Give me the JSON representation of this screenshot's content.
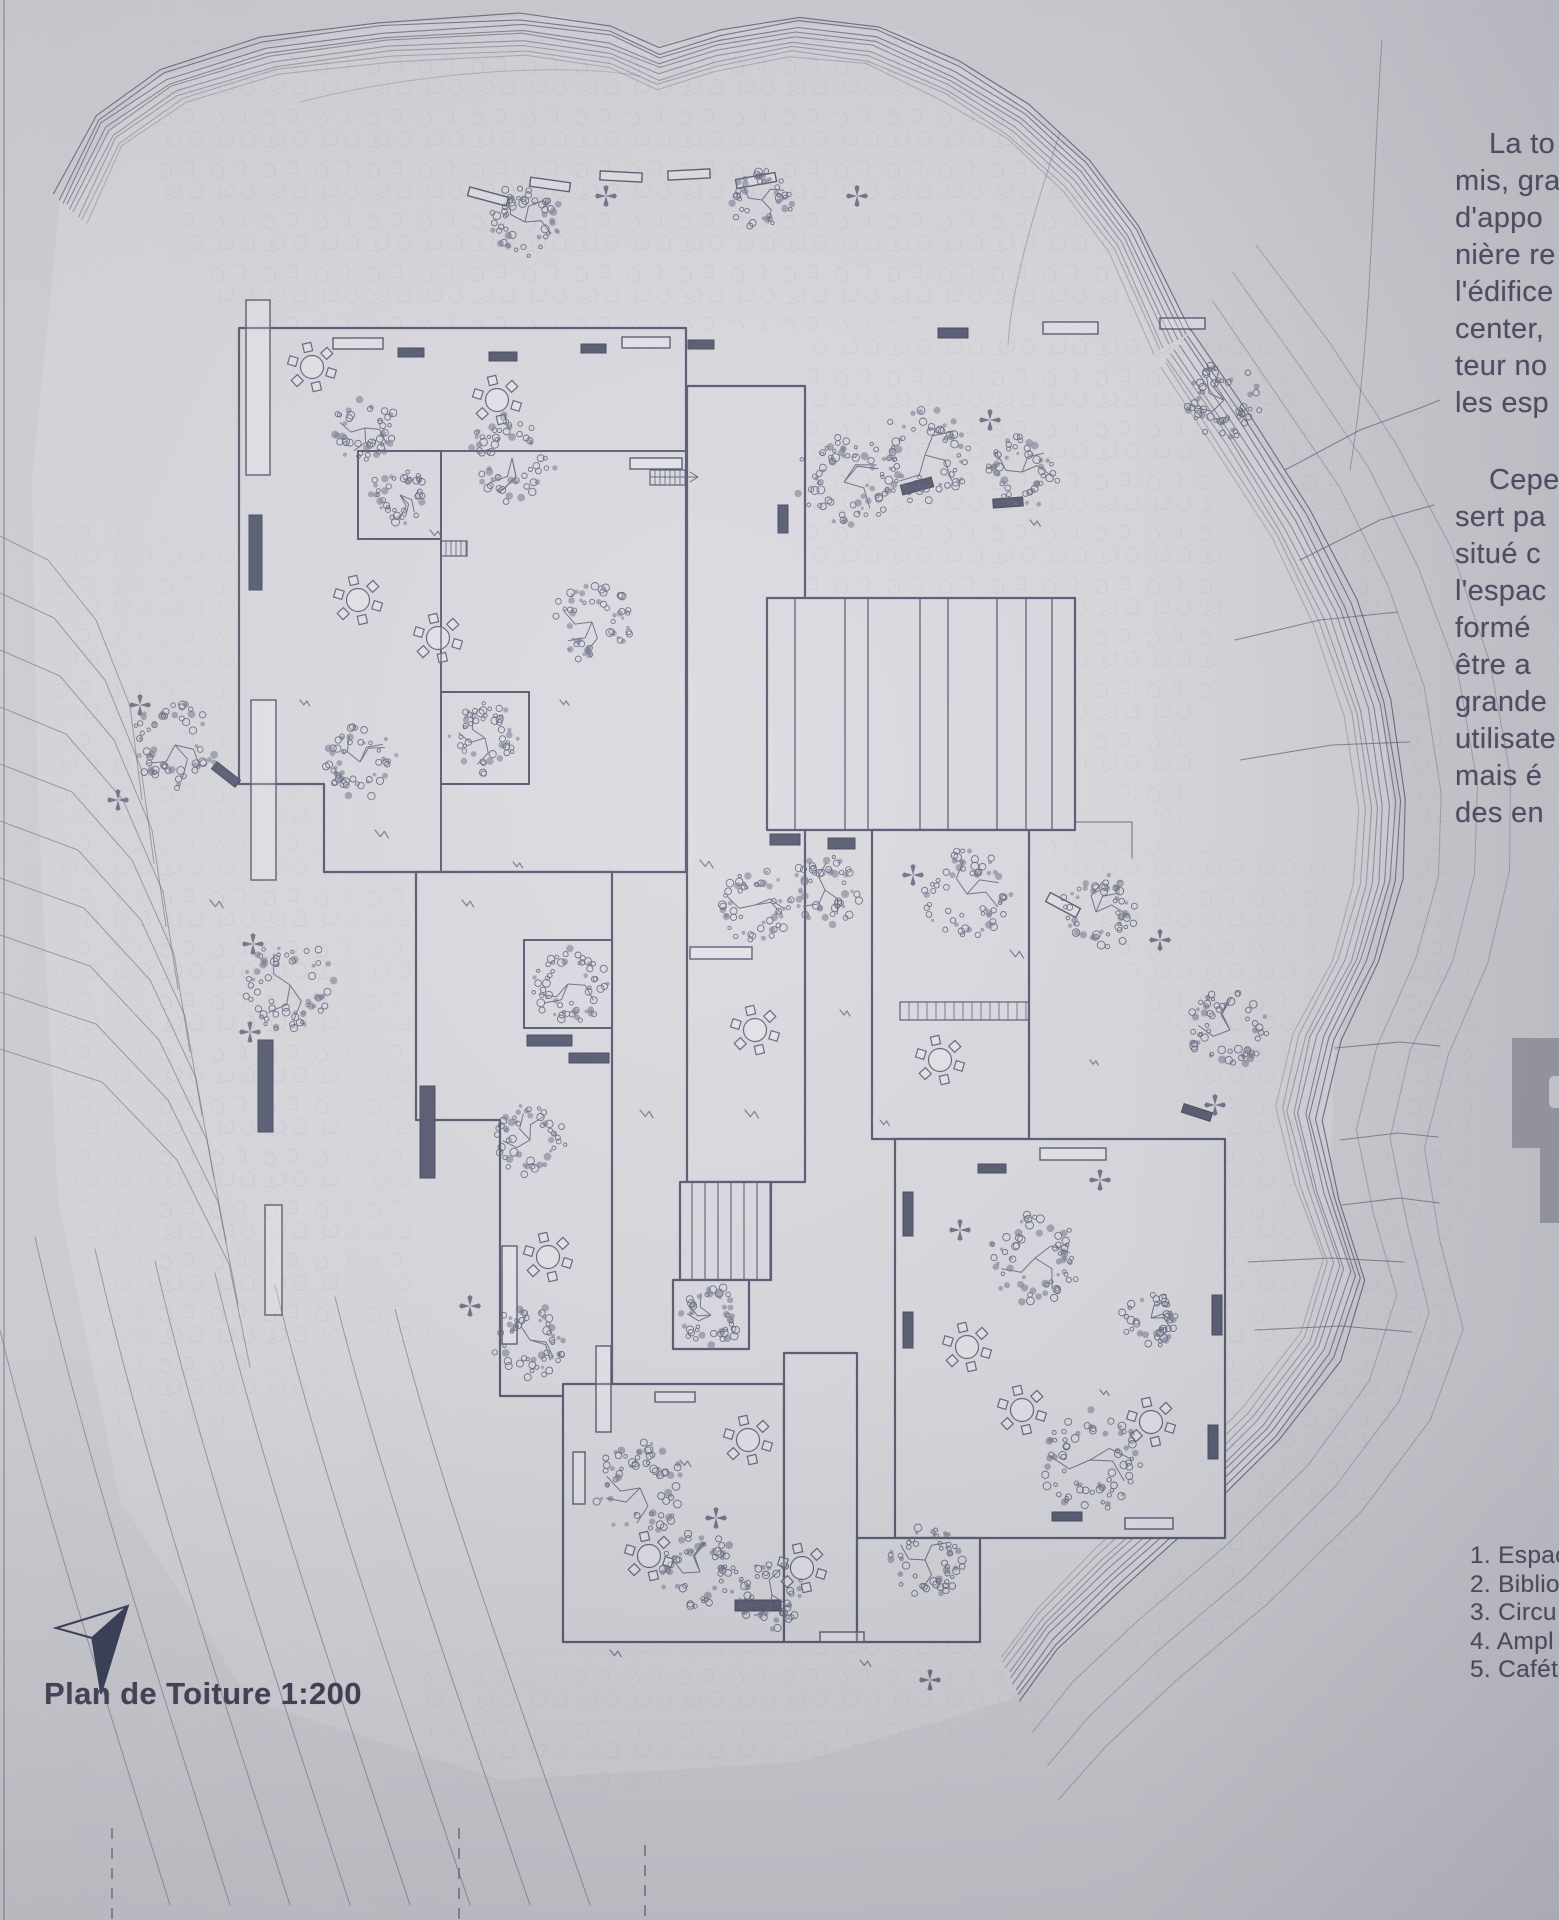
{
  "board": {
    "title": "Plan de Toiture 1:200",
    "paragraph_1": [
      "La to",
      "mis, gra",
      "d'appo",
      "nière re",
      "l'édifice",
      "center,",
      "teur no",
      "les esp"
    ],
    "paragraph_2": [
      "Cepe",
      "sert pa",
      "situé c",
      "l'espac",
      "formé",
      "être a",
      "grande",
      "utilisate",
      "mais é",
      "des en"
    ],
    "legend": {
      "items": [
        "1. Espac",
        "2. Biblio",
        "3. Circu",
        "4. Ampl",
        "5. Cafét"
      ]
    }
  },
  "colors": {
    "paper": "#d2d2d8",
    "site_fill": "#d9d9de",
    "roof_fill": "#dadae0",
    "plan_line": "#565a70",
    "contour_line": "#5e6175",
    "text": "#4a4960",
    "dark_fill": "#555a70",
    "glyph_grey": "#9d9ea6"
  }
}
